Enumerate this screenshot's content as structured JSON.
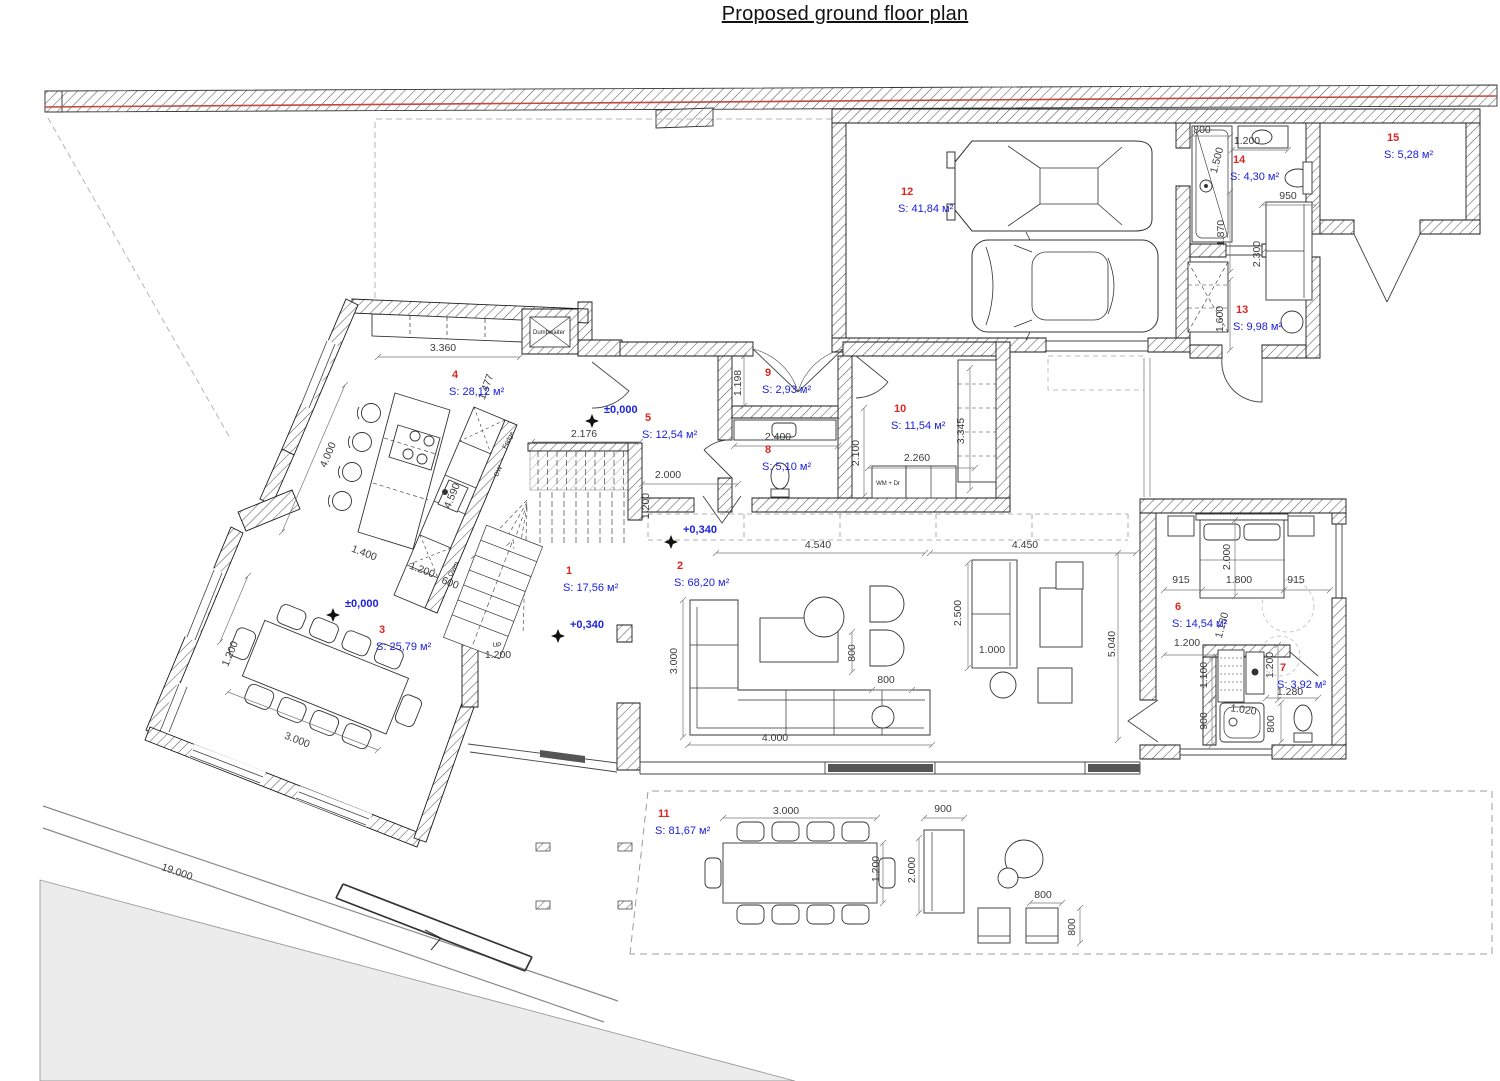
{
  "title": "Proposed ground floor plan",
  "colors": {
    "room_number": "#e02520",
    "room_area": "#1c22dd",
    "dimension": "#3c3c3c",
    "boundary_red": "#bf4a3e",
    "wall_line": "#1a1a1a"
  },
  "rooms": [
    {
      "n": "1",
      "a": "S: 17,56 м²",
      "x": 563,
      "y": 591
    },
    {
      "n": "2",
      "a": "S: 68,20 м²",
      "x": 674,
      "y": 586
    },
    {
      "n": "3",
      "a": "S: 25,79 м²",
      "x": 376,
      "y": 650
    },
    {
      "n": "4",
      "a": "S: 28,12 м²",
      "x": 449,
      "y": 395
    },
    {
      "n": "5",
      "a": "S: 12,54 м²",
      "x": 642,
      "y": 438
    },
    {
      "n": "6",
      "a": "S: 14,54 м²",
      "x": 1172,
      "y": 627
    },
    {
      "n": "7",
      "a": "S: 3,92 м²",
      "x": 1277,
      "y": 688
    },
    {
      "n": "8",
      "a": "S: 5,10 м²",
      "x": 762,
      "y": 470
    },
    {
      "n": "9",
      "a": "S: 2,93 м²",
      "x": 762,
      "y": 393
    },
    {
      "n": "10",
      "a": "S: 11,54 м²",
      "x": 891,
      "y": 429
    },
    {
      "n": "11",
      "a": "S: 81,67 м²",
      "x": 655,
      "y": 834
    },
    {
      "n": "12",
      "a": "S: 41,84 м²",
      "x": 898,
      "y": 212
    },
    {
      "n": "13",
      "a": "S: 9,98 м²",
      "x": 1233,
      "y": 330
    },
    {
      "n": "14",
      "a": "S: 4,30 м²",
      "x": 1230,
      "y": 180
    },
    {
      "n": "15",
      "a": "S: 5,28 м²",
      "x": 1384,
      "y": 158
    }
  ],
  "levels": [
    {
      "t": "±0,000",
      "x": 604,
      "y": 413,
      "mx": 592,
      "my": 421
    },
    {
      "t": "±0,000",
      "x": 345,
      "y": 607,
      "mx": 333,
      "my": 615
    },
    {
      "t": "+0,340",
      "x": 683,
      "y": 533,
      "mx": 671,
      "my": 542
    },
    {
      "t": "+0,340",
      "x": 570,
      "y": 628,
      "mx": 558,
      "my": 636
    }
  ],
  "dims": [
    {
      "t": "3.360",
      "x": 443,
      "y": 351,
      "r": 0
    },
    {
      "t": "1.477",
      "x": 489,
      "y": 388,
      "r": -70
    },
    {
      "t": "4.000",
      "x": 331,
      "y": 456,
      "r": -67
    },
    {
      "t": "4.590",
      "x": 455,
      "y": 497,
      "r": -67
    },
    {
      "t": "1.400",
      "x": 363,
      "y": 556,
      "r": 21
    },
    {
      "t": "1.200",
      "x": 421,
      "y": 573,
      "r": 21
    },
    {
      "t": "600",
      "x": 449,
      "y": 586,
      "r": 21
    },
    {
      "t": "1.200",
      "x": 233,
      "y": 655,
      "r": -67
    },
    {
      "t": "3.000",
      "x": 296,
      "y": 743,
      "r": 21
    },
    {
      "t": "19.000",
      "x": 176,
      "y": 875,
      "r": 19
    },
    {
      "t": "2.176",
      "x": 584,
      "y": 437,
      "r": 0
    },
    {
      "t": "2.000",
      "x": 668,
      "y": 478,
      "r": 0
    },
    {
      "t": "1.200",
      "x": 649,
      "y": 506,
      "r": -90
    },
    {
      "t": "1.200",
      "x": 498,
      "y": 658,
      "r": 0
    },
    {
      "t": "1.198",
      "x": 741,
      "y": 383,
      "r": -90
    },
    {
      "t": "2.400",
      "x": 778,
      "y": 440,
      "r": 0
    },
    {
      "t": "2.100",
      "x": 859,
      "y": 453,
      "r": -90
    },
    {
      "t": "2.260",
      "x": 917,
      "y": 461,
      "r": 0
    },
    {
      "t": "3.345",
      "x": 964,
      "y": 431,
      "r": -90
    },
    {
      "t": "4.540",
      "x": 818,
      "y": 548,
      "r": 0
    },
    {
      "t": "4.450",
      "x": 1025,
      "y": 548,
      "r": 0
    },
    {
      "t": "3.000",
      "x": 677,
      "y": 661,
      "r": -90
    },
    {
      "t": "800",
      "x": 855,
      "y": 653,
      "r": -90
    },
    {
      "t": "800",
      "x": 886,
      "y": 683,
      "r": 0
    },
    {
      "t": "2.500",
      "x": 961,
      "y": 613,
      "r": -90
    },
    {
      "t": "1.000",
      "x": 992,
      "y": 653,
      "r": 0
    },
    {
      "t": "5.040",
      "x": 1115,
      "y": 644,
      "r": -90
    },
    {
      "t": "4.000",
      "x": 775,
      "y": 741,
      "r": 0
    },
    {
      "t": "915",
      "x": 1181,
      "y": 583,
      "r": 0
    },
    {
      "t": "1.800",
      "x": 1239,
      "y": 583,
      "r": 0
    },
    {
      "t": "915",
      "x": 1296,
      "y": 583,
      "r": 0
    },
    {
      "t": "2.000",
      "x": 1230,
      "y": 557,
      "r": -90
    },
    {
      "t": "1.130",
      "x": 1225,
      "y": 626,
      "r": -75
    },
    {
      "t": "1.200",
      "x": 1187,
      "y": 646,
      "r": 0
    },
    {
      "t": "1.100",
      "x": 1207,
      "y": 675,
      "r": -90
    },
    {
      "t": "900",
      "x": 1207,
      "y": 721,
      "r": -90
    },
    {
      "t": "1.200",
      "x": 1273,
      "y": 665,
      "r": -90
    },
    {
      "t": "1.020",
      "x": 1243,
      "y": 713,
      "r": 8
    },
    {
      "t": "800",
      "x": 1274,
      "y": 724,
      "r": -90
    },
    {
      "t": "1.280",
      "x": 1290,
      "y": 695,
      "r": 0
    },
    {
      "t": "800",
      "x": 1202,
      "y": 133,
      "r": 0
    },
    {
      "t": "1.500",
      "x": 1220,
      "y": 161,
      "r": -75
    },
    {
      "t": "1.200",
      "x": 1247,
      "y": 144,
      "r": 0
    },
    {
      "t": "950",
      "x": 1288,
      "y": 199,
      "r": 0
    },
    {
      "t": "2.300",
      "x": 1260,
      "y": 254,
      "r": -90
    },
    {
      "t": "1.870",
      "x": 1224,
      "y": 233,
      "r": -90
    },
    {
      "t": "1.600",
      "x": 1223,
      "y": 319,
      "r": -90
    },
    {
      "t": "3.000",
      "x": 786,
      "y": 814,
      "r": 0
    },
    {
      "t": "1.200",
      "x": 879,
      "y": 869,
      "r": -90
    },
    {
      "t": "900",
      "x": 943,
      "y": 812,
      "r": 0
    },
    {
      "t": "2.000",
      "x": 915,
      "y": 870,
      "r": -90
    },
    {
      "t": "800",
      "x": 1043,
      "y": 898,
      "r": 0
    },
    {
      "t": "800",
      "x": 1075,
      "y": 927,
      "r": -90
    }
  ],
  "notes": [
    {
      "t": "Dumbwaiter",
      "x": 549,
      "y": 334,
      "r": 0,
      "s": 6
    },
    {
      "t": "Fridge",
      "x": 510,
      "y": 441,
      "r": -64,
      "s": 6.5
    },
    {
      "t": "DW",
      "x": 500,
      "y": 472,
      "r": -64,
      "s": 6.5
    },
    {
      "t": "Oven",
      "x": 455,
      "y": 570,
      "r": -64,
      "s": 6.5
    },
    {
      "t": "WM + Dr",
      "x": 888,
      "y": 485,
      "r": 0,
      "s": 6
    },
    {
      "t": "UP",
      "x": 497,
      "y": 647,
      "r": 0,
      "s": 6.5
    }
  ]
}
